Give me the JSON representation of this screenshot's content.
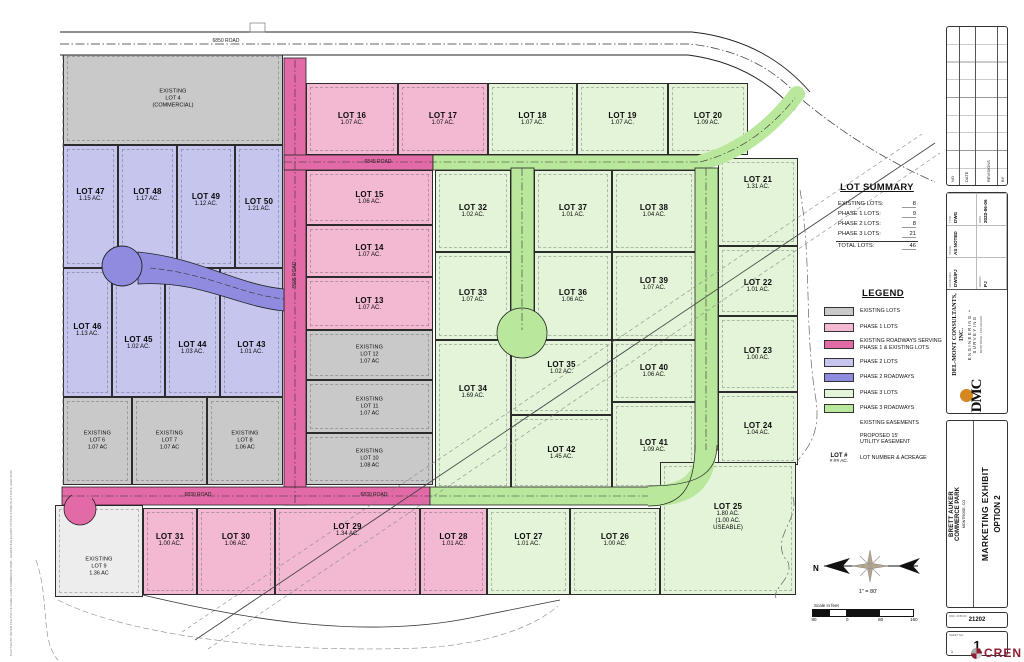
{
  "colors": {
    "existing_fill": "#c9c9c9",
    "phase1_lot": "#f3b9d3",
    "phase1_road": "#e26aa6",
    "phase2_lot": "#c6c5ee",
    "phase2_road": "#8f8ce0",
    "phase3_lot": "#e3f4d8",
    "phase3_road": "#b9e79b",
    "cren_red": "#8c1d32",
    "dmc_gold": "#d4881f"
  },
  "map": {
    "road_labels": [
      {
        "text": "6850 ROAD",
        "x": 200,
        "y": 38,
        "rot": 0
      },
      {
        "text": "6845 ROAD",
        "x": 352,
        "y": 159,
        "rot": 0
      },
      {
        "text": "6830 ROAD",
        "x": 172,
        "y": 492,
        "rot": 0
      },
      {
        "text": "6830 ROAD",
        "x": 348,
        "y": 492,
        "rot": 0
      },
      {
        "text": "6595 ROAD",
        "x": 269,
        "y": 272,
        "rot": -90
      }
    ],
    "lots": [
      {
        "id": "4",
        "phase": "existing",
        "x": 63,
        "y": 52,
        "w": 220,
        "h": 93,
        "lines": [
          "EXISTING",
          "LOT 4",
          "(COMMERCIAL)"
        ]
      },
      {
        "id": "47",
        "phase": "phase2",
        "x": 63,
        "y": 145,
        "w": 55,
        "h": 123,
        "lines": [
          "LOT 47",
          "1.15 AC."
        ],
        "ly": 50
      },
      {
        "id": "48",
        "phase": "phase2",
        "x": 118,
        "y": 145,
        "w": 59,
        "h": 123,
        "lines": [
          "LOT 48",
          "1.17 AC."
        ],
        "ly": 50
      },
      {
        "id": "49",
        "phase": "phase2",
        "x": 177,
        "y": 145,
        "w": 58,
        "h": 123,
        "lines": [
          "LOT 49",
          "1.12 AC."
        ],
        "ly": 55
      },
      {
        "id": "50",
        "phase": "phase2",
        "x": 235,
        "y": 145,
        "w": 48,
        "h": 123,
        "lines": [
          "LOT 50",
          "1.21 AC."
        ],
        "ly": 60
      },
      {
        "id": "46",
        "phase": "phase2",
        "x": 63,
        "y": 268,
        "w": 49,
        "h": 129,
        "lines": [
          "LOT 46",
          "1.13 AC."
        ],
        "ly": 62
      },
      {
        "id": "45",
        "phase": "phase2",
        "x": 112,
        "y": 268,
        "w": 53,
        "h": 129,
        "lines": [
          "LOT 45",
          "1.02 AC."
        ],
        "ly": 75
      },
      {
        "id": "44",
        "phase": "phase2",
        "x": 165,
        "y": 268,
        "w": 55,
        "h": 129,
        "lines": [
          "LOT 44",
          "1.03 AC."
        ],
        "ly": 80
      },
      {
        "id": "43",
        "phase": "phase2",
        "x": 220,
        "y": 268,
        "w": 63,
        "h": 129,
        "lines": [
          "LOT 43",
          "1.01 AC."
        ],
        "ly": 80
      },
      {
        "id": "6",
        "phase": "existing",
        "x": 63,
        "y": 397,
        "w": 69,
        "h": 88,
        "lines": [
          "EXISTING",
          "LOT 6",
          "1.07 AC"
        ]
      },
      {
        "id": "7",
        "phase": "existing",
        "x": 132,
        "y": 397,
        "w": 75,
        "h": 88,
        "lines": [
          "EXISTING",
          "LOT 7",
          "1.07 AC"
        ]
      },
      {
        "id": "8",
        "phase": "existing",
        "x": 207,
        "y": 397,
        "w": 76,
        "h": 88,
        "lines": [
          "EXISTING",
          "LOT 8",
          "1.06 AC"
        ]
      },
      {
        "id": "9",
        "phase": "existing-light",
        "x": 55,
        "y": 505,
        "w": 88,
        "h": 92,
        "lines": [
          "EXISTING",
          "LOT 9",
          "1.36 AC"
        ],
        "ly": 62
      },
      {
        "id": "16",
        "phase": "phase1",
        "x": 306,
        "y": 83,
        "w": 92,
        "h": 72,
        "lines": [
          "LOT 16",
          "1.07 AC."
        ]
      },
      {
        "id": "17",
        "phase": "phase1",
        "x": 398,
        "y": 83,
        "w": 90,
        "h": 72,
        "lines": [
          "LOT 17",
          "1.07 AC."
        ]
      },
      {
        "id": "18",
        "phase": "phase3",
        "x": 488,
        "y": 83,
        "w": 89,
        "h": 72,
        "lines": [
          "LOT 18",
          "1.07 AC."
        ]
      },
      {
        "id": "19",
        "phase": "phase3",
        "x": 577,
        "y": 83,
        "w": 91,
        "h": 72,
        "lines": [
          "LOT 19",
          "1.07 AC."
        ]
      },
      {
        "id": "20",
        "phase": "phase3",
        "x": 668,
        "y": 83,
        "w": 80,
        "h": 72,
        "lines": [
          "LOT 20",
          "1.09 AC."
        ]
      },
      {
        "id": "15",
        "phase": "phase1",
        "x": 306,
        "y": 170,
        "w": 127,
        "h": 55,
        "lines": [
          "LOT 15",
          "1.06 AC."
        ]
      },
      {
        "id": "14",
        "phase": "phase1",
        "x": 306,
        "y": 225,
        "w": 127,
        "h": 52,
        "lines": [
          "LOT 14",
          "1.07 AC."
        ]
      },
      {
        "id": "13",
        "phase": "phase1",
        "x": 306,
        "y": 277,
        "w": 127,
        "h": 53,
        "lines": [
          "LOT 13",
          "1.07 AC."
        ]
      },
      {
        "id": "12",
        "phase": "existing",
        "x": 306,
        "y": 330,
        "w": 127,
        "h": 50,
        "lines": [
          "EXISTING",
          "LOT 12",
          "1.07 AC"
        ]
      },
      {
        "id": "11",
        "phase": "existing",
        "x": 306,
        "y": 380,
        "w": 127,
        "h": 53,
        "lines": [
          "EXISTING",
          "LOT 11",
          "1.07 AC"
        ]
      },
      {
        "id": "10",
        "phase": "existing",
        "x": 306,
        "y": 433,
        "w": 127,
        "h": 52,
        "lines": [
          "EXISTING",
          "LOT 10",
          "1.08 AC"
        ]
      },
      {
        "id": "32",
        "phase": "phase3",
        "x": 435,
        "y": 170,
        "w": 76,
        "h": 82,
        "lines": [
          "LOT 32",
          "1.02 AC."
        ]
      },
      {
        "id": "37",
        "phase": "phase3",
        "x": 534,
        "y": 170,
        "w": 78,
        "h": 82,
        "lines": [
          "LOT 37",
          "1.01 AC."
        ]
      },
      {
        "id": "38",
        "phase": "phase3",
        "x": 612,
        "y": 170,
        "w": 84,
        "h": 82,
        "lines": [
          "LOT 38",
          "1.04 AC."
        ]
      },
      {
        "id": "33",
        "phase": "phase3",
        "x": 435,
        "y": 252,
        "w": 76,
        "h": 88,
        "lines": [
          "LOT 33",
          "1.07 AC."
        ]
      },
      {
        "id": "36",
        "phase": "phase3",
        "x": 534,
        "y": 252,
        "w": 78,
        "h": 88,
        "lines": [
          "LOT 36",
          "1.06 AC."
        ]
      },
      {
        "id": "39",
        "phase": "phase3",
        "x": 612,
        "y": 252,
        "w": 84,
        "h": 88,
        "lines": [
          "LOT 39",
          "1.07 AC."
        ],
        "ly": 32
      },
      {
        "id": "34",
        "phase": "phase3",
        "x": 435,
        "y": 340,
        "w": 76,
        "h": 150,
        "lines": [
          "LOT 34",
          "1.69 AC."
        ],
        "ly": 52
      },
      {
        "id": "35",
        "phase": "phase3",
        "x": 511,
        "y": 340,
        "w": 101,
        "h": 75,
        "lines": [
          "LOT 35",
          "1.02 AC."
        ],
        "ly": 28
      },
      {
        "id": "40",
        "phase": "phase3",
        "x": 612,
        "y": 340,
        "w": 84,
        "h": 62,
        "lines": [
          "LOT 40",
          "1.06 AC."
        ]
      },
      {
        "id": "42",
        "phase": "phase3",
        "x": 511,
        "y": 415,
        "w": 101,
        "h": 75,
        "lines": [
          "LOT 42",
          "1.45 AC."
        ]
      },
      {
        "id": "41",
        "phase": "phase3",
        "x": 612,
        "y": 402,
        "w": 84,
        "h": 88,
        "lines": [
          "LOT 41",
          "1.09 AC."
        ]
      },
      {
        "id": "21",
        "phase": "phase3",
        "x": 718,
        "y": 158,
        "w": 80,
        "h": 88,
        "lines": [
          "LOT 21",
          "1.31 AC."
        ],
        "ly": 25
      },
      {
        "id": "22",
        "phase": "phase3",
        "x": 718,
        "y": 246,
        "w": 80,
        "h": 70,
        "lines": [
          "LOT 22",
          "1.01 AC."
        ],
        "ly": 40
      },
      {
        "id": "23",
        "phase": "phase3",
        "x": 718,
        "y": 316,
        "w": 80,
        "h": 76,
        "lines": [
          "LOT 23",
          "1.00 AC."
        ]
      },
      {
        "id": "24",
        "phase": "phase3",
        "x": 718,
        "y": 392,
        "w": 80,
        "h": 73,
        "lines": [
          "LOT 24",
          "1.04 AC."
        ]
      },
      {
        "id": "25",
        "phase": "phase3",
        "x": 660,
        "y": 462,
        "w": 136,
        "h": 133,
        "lines": [
          "LOT 25",
          "1.80 AC.",
          "(1.00 AC.",
          "USEABLE)"
        ],
        "ly": 55
      },
      {
        "id": "31",
        "phase": "phase1",
        "x": 143,
        "y": 508,
        "w": 54,
        "h": 87,
        "lines": [
          "LOT 31",
          "1.00 AC."
        ],
        "ly": 32
      },
      {
        "id": "30",
        "phase": "phase1",
        "x": 197,
        "y": 508,
        "w": 78,
        "h": 87,
        "lines": [
          "LOT 30",
          "1.06 AC."
        ],
        "ly": 32
      },
      {
        "id": "29",
        "phase": "phase1",
        "x": 275,
        "y": 508,
        "w": 145,
        "h": 87,
        "lines": [
          "LOT 29",
          "1.34 AC."
        ],
        "ly": 22
      },
      {
        "id": "28",
        "phase": "phase1",
        "x": 420,
        "y": 508,
        "w": 67,
        "h": 87,
        "lines": [
          "LOT 28",
          "1.01 AC."
        ],
        "ly": 32
      },
      {
        "id": "27",
        "phase": "phase3",
        "x": 487,
        "y": 508,
        "w": 83,
        "h": 87,
        "lines": [
          "LOT 27",
          "1.01 AC."
        ],
        "ly": 32
      },
      {
        "id": "26",
        "phase": "phase3",
        "x": 570,
        "y": 508,
        "w": 90,
        "h": 87,
        "lines": [
          "LOT 26",
          "1.00 AC."
        ],
        "ly": 32
      }
    ],
    "lot_summary": {
      "title": "LOT SUMMARY",
      "rows": [
        {
          "label": "EXISTING LOTS:",
          "value": "8"
        },
        {
          "label": "PHASE 1 LOTS:",
          "value": "9"
        },
        {
          "label": "PHASE 2 LOTS:",
          "value": "8"
        },
        {
          "label": "PHASE 3 LOTS:",
          "value": "21"
        },
        {
          "label": "TOTAL LOTS:",
          "value": "46",
          "total": true
        }
      ]
    },
    "legend": {
      "title": "LEGEND",
      "items": [
        {
          "swatch": "existing",
          "label": "EXISTING LOTS"
        },
        {
          "swatch": "phase1lot",
          "label": "PHASE 1 LOTS"
        },
        {
          "swatch": "phase1road",
          "label": "EXISTING ROADWAYS SERVING\nPHASE 1 & EXISTING LOTS"
        },
        {
          "swatch": "phase2lot",
          "label": "PHASE 2 LOTS"
        },
        {
          "swatch": "phase2road",
          "label": "PHASE 2 ROADWAYS"
        },
        {
          "swatch": "phase3lot",
          "label": "PHASE 3 LOTS"
        },
        {
          "swatch": "phase3road",
          "label": "PHASE 3 ROADWAYS"
        },
        {
          "swatch": "easement",
          "label": "EXISTING EASEMENTS"
        },
        {
          "swatch": "utility",
          "label": "PROPOSED 15'\nUTILITY EASEMENT"
        },
        {
          "swatch": "lotnum",
          "label": "LOT NUMBER & ACREAGE",
          "sym_line1": "LOT #",
          "sym_line2": "#.## AC."
        }
      ]
    },
    "north_label": "N",
    "scale_text": "1\" = 80'",
    "scale_bar": {
      "caption": "Scale in feet",
      "labels": [
        "80",
        "0",
        "80",
        "160"
      ]
    }
  },
  "title_block": {
    "revisions": {
      "captions": [
        "NO",
        "DATE",
        "REVISIONS",
        "BY"
      ]
    },
    "company": {
      "logo_text": "DMC",
      "name": "DEL-MONT CONSULTANTS, INC.",
      "tagline": "ENGINEERING • SURVEYING",
      "address": "MONTROSE • COLORADO",
      "fields": [
        {
          "cap": "DESIGNED",
          "val": "DWS/PJ"
        },
        {
          "cap": "SCALE",
          "val": "AS NOTED"
        },
        {
          "cap": "TYPE",
          "val": "DWG"
        },
        {
          "cap": "DRAWN",
          "val": "PJ"
        },
        {
          "cap": "",
          "val": ""
        },
        {
          "cap": "DATE",
          "val": "2022-06-06"
        }
      ]
    },
    "project": {
      "client_line1": "BRETT AUKER",
      "client_line2": "COMMERCE PARK",
      "client_line3": "MONTROSE, CO",
      "title_line1": "MARKETING EXHIBIT",
      "title_line2": "OPTION 2"
    },
    "job": {
      "caption": "DMC JOB NO.",
      "number": "21202"
    },
    "sheet": {
      "caption": "SHEET NO.",
      "number": "1",
      "sub": "1"
    }
  },
  "cren_logo": {
    "text": "CREN"
  },
  "plot_stamp": "PLOTTED BY: PETER   FILE PATH & NAME: 21202 COMMERCE PARK - MARKETING EXHIBIT OPTION 2.DWG   PLOT DATE: 2022-06-06"
}
